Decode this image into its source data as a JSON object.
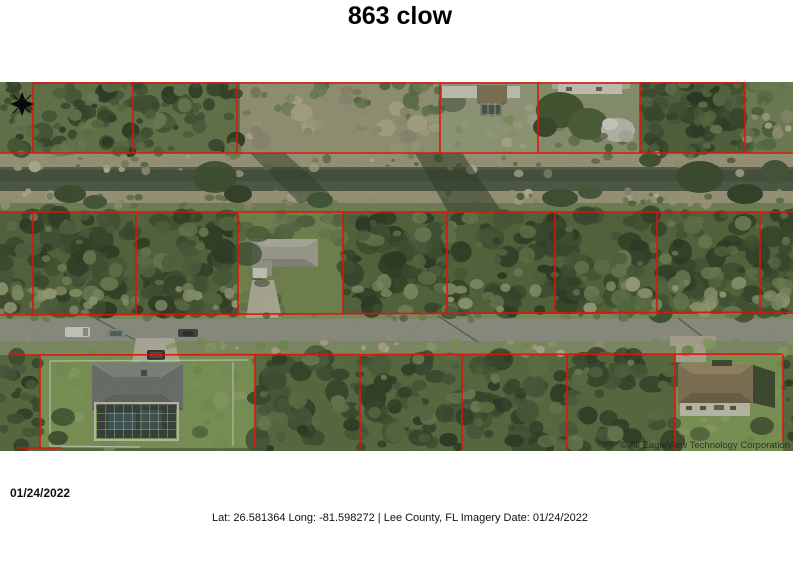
{
  "title": "863 clow",
  "map": {
    "watermark": "© All EagleView Technology Corporation",
    "date_label": "01/24/2022",
    "parcel_line_color": "#df1408"
  },
  "footer": {
    "caption": "Lat: 26.581364 Long: -81.598272 | Lee County, FL Imagery Date: 01/24/2022"
  }
}
